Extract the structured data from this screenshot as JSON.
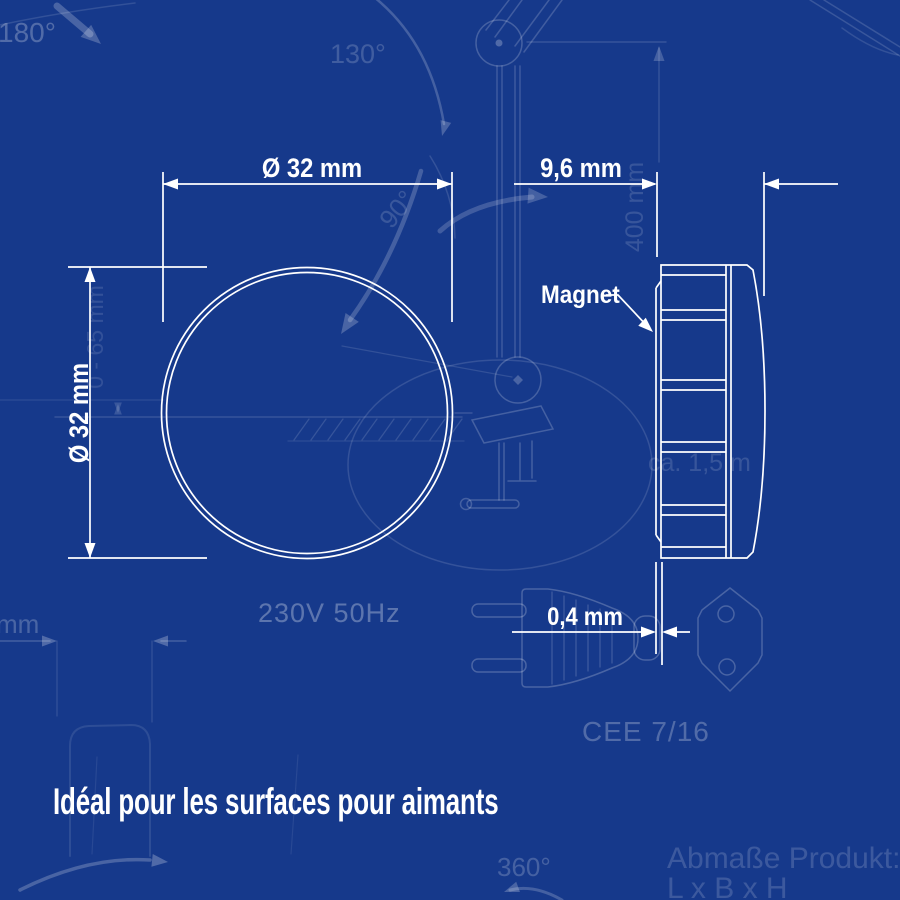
{
  "colors": {
    "background": "#16398b",
    "drawing_bright": "#ffffff",
    "blueprint_faint": "#8fa8dc"
  },
  "front_view": {
    "diameter_horizontal": "Ø 32 mm",
    "diameter_vertical": "Ø 32 mm"
  },
  "side_view": {
    "depth": "9,6 mm",
    "plate_thickness": "0,4 mm",
    "part_label": "Magnet"
  },
  "background_blueprint": {
    "angle_180": "180°",
    "angle_130": "130°",
    "angle_90": "90°",
    "angle_360": "360°",
    "reach_dim": "400 mm",
    "height_range_dim": "0 - 65 mm",
    "power_rating": "230V  50Hz",
    "cable_length": "ca. 1,5 m",
    "plug_standard": "CEE 7/16",
    "product_dims_label": "Abmaße Produkt:",
    "product_dims_formula": "L x B x H",
    "edge_text_fragment": "mm"
  },
  "caption": {
    "text": "Idéal pour les surfaces pour aimants"
  }
}
